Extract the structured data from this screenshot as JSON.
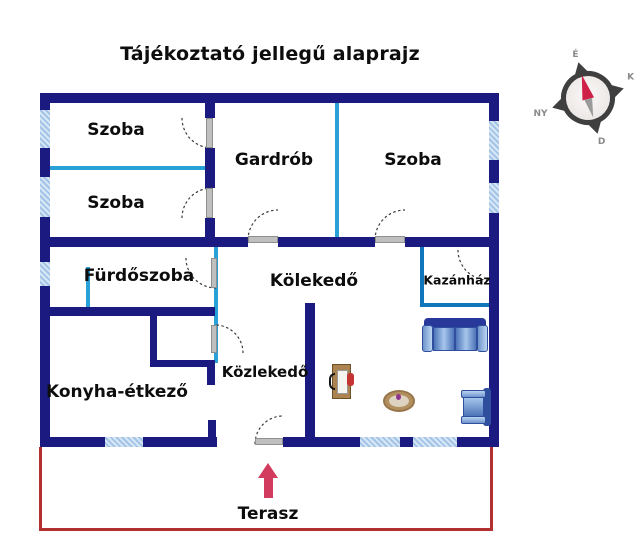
{
  "title": "Tájékoztató jellegű alaprajz",
  "rooms": {
    "szoba_top_left": "Szoba",
    "szoba_bottom_left": "Szoba",
    "gardrob": "Gardrób",
    "szoba_right": "Szoba",
    "furdoszoba": "Fürdőszoba",
    "kolekedo": "Kölekedő",
    "kazanhaz": "Kazánház",
    "konyha_etkezo": "Konyha-étkező",
    "kozlekedo": "Közlekedő",
    "terasz": "Terasz"
  },
  "compass": {
    "north": "É",
    "east": "K",
    "south": "D",
    "west": "NY"
  },
  "colors": {
    "wall": "#1a1a80",
    "partition_line": "#2aa1d6",
    "boiler_room_border": "#0f76bb",
    "window_fill": "#c9ddf1",
    "terrace_border": "#b23030",
    "entrance_arrow": "#d23a5e",
    "door_leaf": "#bfbfbf",
    "sofa_blue": "#4d74b8"
  }
}
